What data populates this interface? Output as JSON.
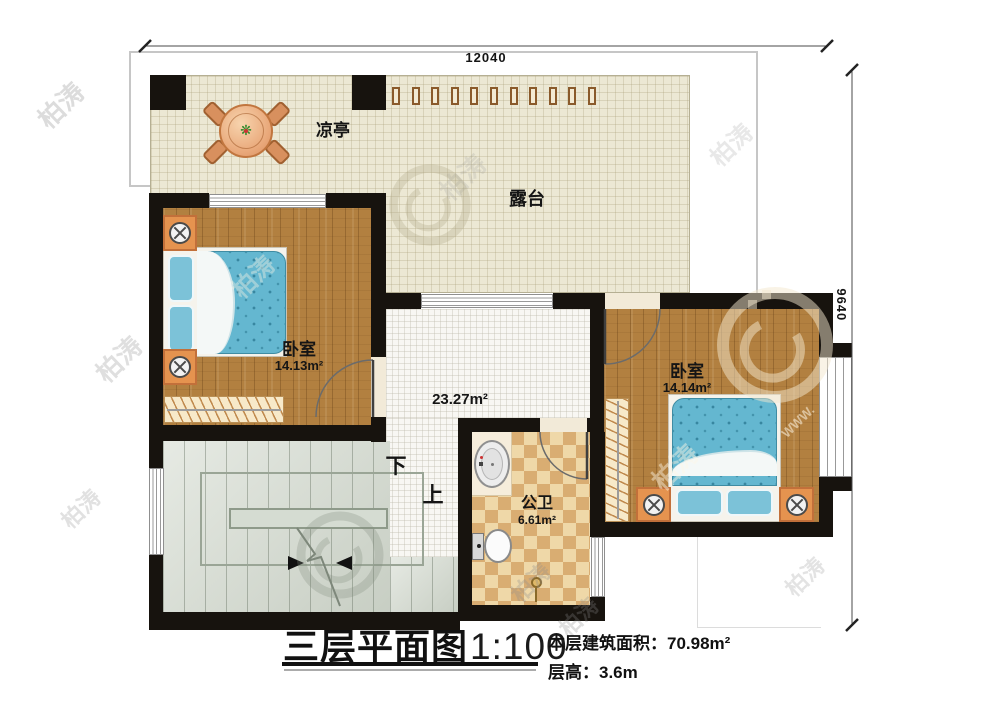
{
  "dimensions": {
    "top": "12040",
    "right": "9640"
  },
  "rooms": {
    "terrace": {
      "label": "露台"
    },
    "pavilion": {
      "label": "凉亭"
    },
    "bedroom_left": {
      "label": "卧室",
      "area": "14.13m²"
    },
    "bedroom_right": {
      "label": "卧室",
      "area": "14.14m²"
    },
    "hall": {
      "area": "23.27m²"
    },
    "bathroom": {
      "label": "公卫",
      "area": "6.61m²"
    },
    "stairs": {
      "down": "下",
      "up": "上"
    }
  },
  "title_block": {
    "title": "三层平面图",
    "scale": "1:100",
    "building_area": "本层建筑面积：70.98m²",
    "floor_height": "层高：3.6m"
  },
  "watermark": {
    "text": "柏涛",
    "url": "WWW."
  },
  "colors": {
    "wall": "#17130e",
    "terrace_floor": "#ece8d4",
    "wood_floor": "#b28040",
    "mattress": "#64b7d0",
    "tile_light": "#efd8a8",
    "tile_dark": "#d9ad72",
    "stairs": "#d9dfd5",
    "furniture_accent": "#e5934f"
  }
}
